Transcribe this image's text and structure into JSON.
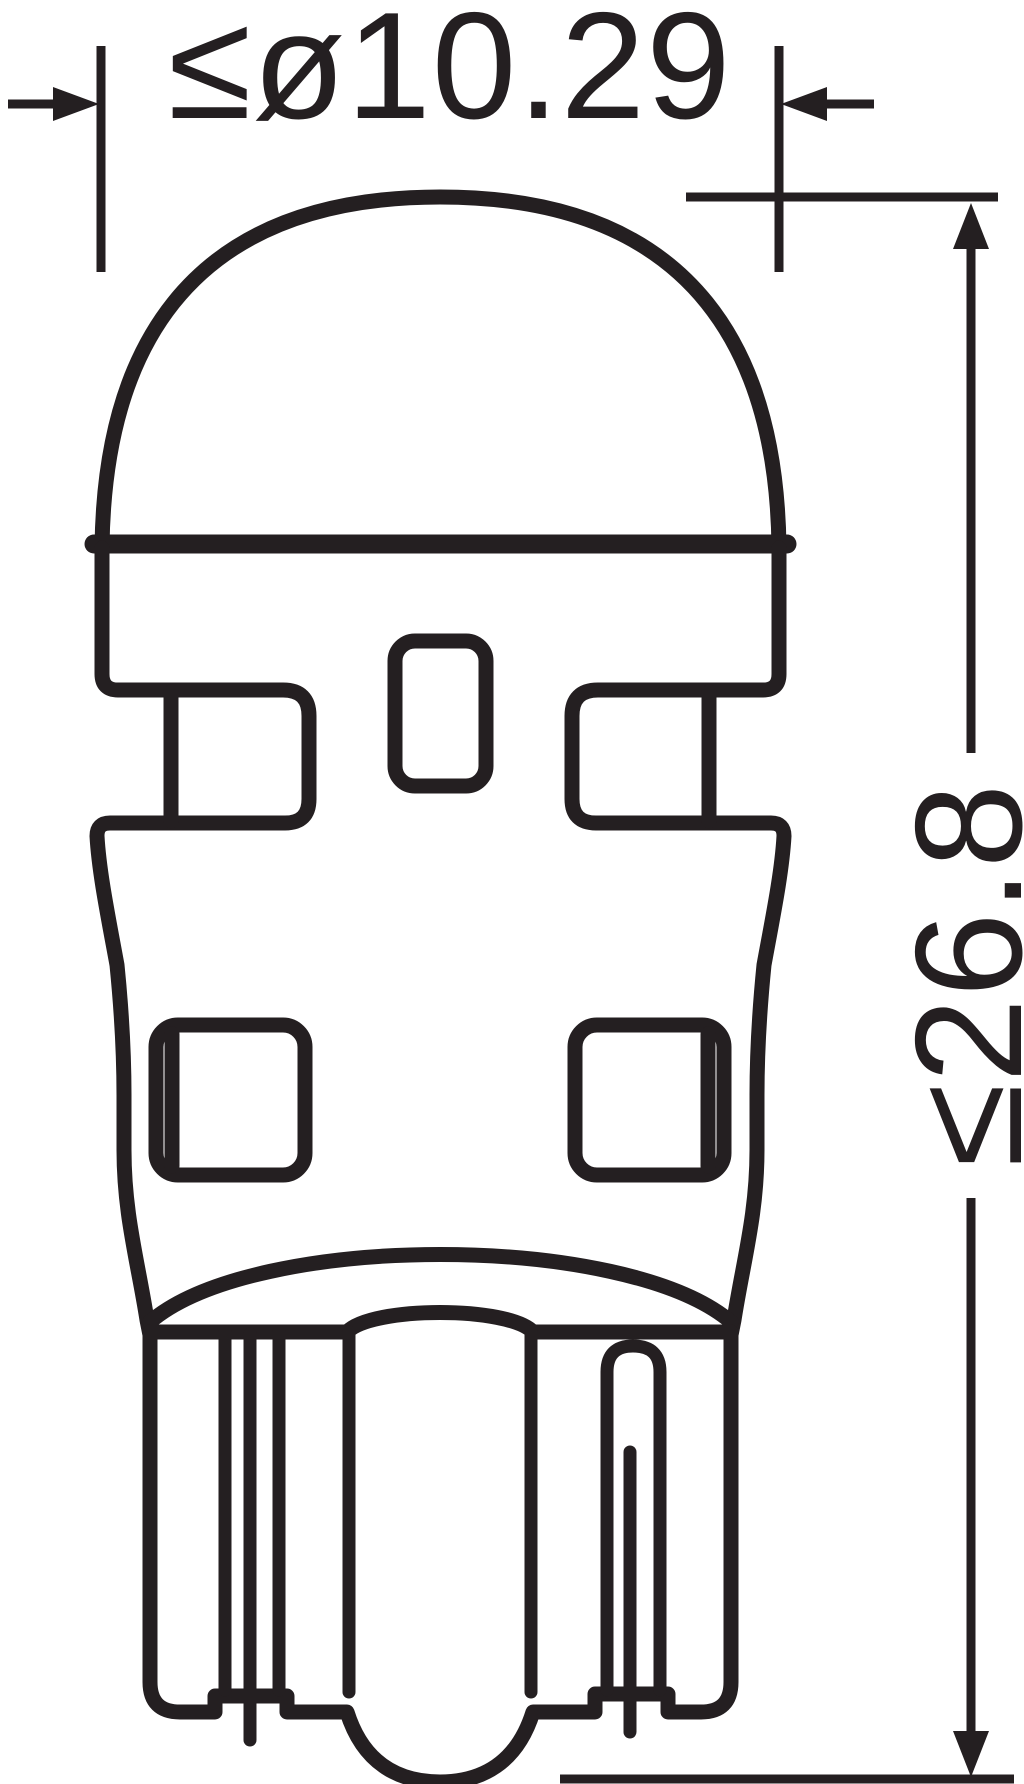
{
  "drawing": {
    "subject": "wedge-base LED bulb outline drawing",
    "dimensions": {
      "diameter": {
        "label": "≤ø10.29",
        "value": 10.29,
        "constraint": "max-diameter"
      },
      "height": {
        "label": "≤26.8",
        "value": 26.8,
        "constraint": "max-height"
      }
    },
    "colors": {
      "ink": "#241f21",
      "background": "#ffffff"
    }
  }
}
